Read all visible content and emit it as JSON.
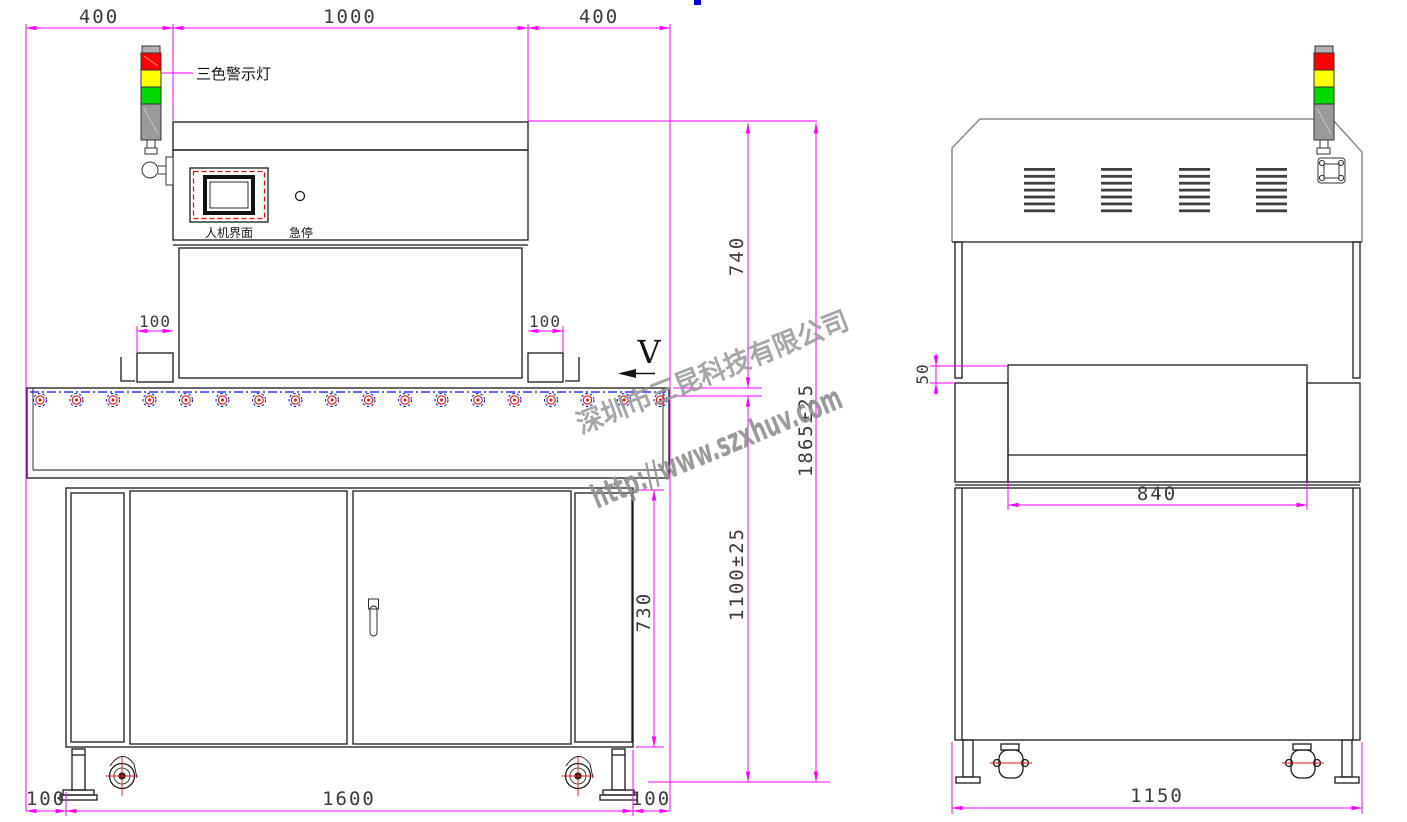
{
  "front_view": {
    "dim_top_left": "400",
    "dim_top_center": "1000",
    "dim_top_right": "400",
    "dim_support_left": "100",
    "dim_support_right": "100",
    "dim_upper_height": "740",
    "dim_total_height": "1865±25",
    "dim_belt_height": "1100±25",
    "dim_cabinet_height": "730",
    "dim_bottom_left": "100",
    "dim_bottom_center": "1600",
    "dim_bottom_right": "100",
    "label_warning_light": "三色警示灯",
    "label_hmi": "人机界面",
    "label_estop": "急停",
    "label_direction": "V"
  },
  "side_view": {
    "dim_step": "50",
    "dim_conveyor_width": "840",
    "dim_overall_depth": "1150"
  },
  "watermark": {
    "company": "深圳市三昆科技有限公司",
    "website": "http://www.szxhuv.com"
  },
  "conveyor": {
    "roller_count": 18
  },
  "side_vents": {
    "groups": 4,
    "slats": 7
  },
  "colors": {
    "dimension_magenta": "#ff00ff",
    "centerline_blue": "#0011ee",
    "roller_red": "#e11414",
    "light_red": "#ff0000",
    "light_yellow": "#ffff00",
    "light_green": "#00d900",
    "light_gray": "#9a9a9a",
    "outline_black": "#1a1a1a",
    "hood_gray": "#8a8a8a",
    "watermark_gray": "#9a9a9a",
    "dim_text_gray": "#3b3b3b",
    "artifact_blue": "#0000d9"
  }
}
